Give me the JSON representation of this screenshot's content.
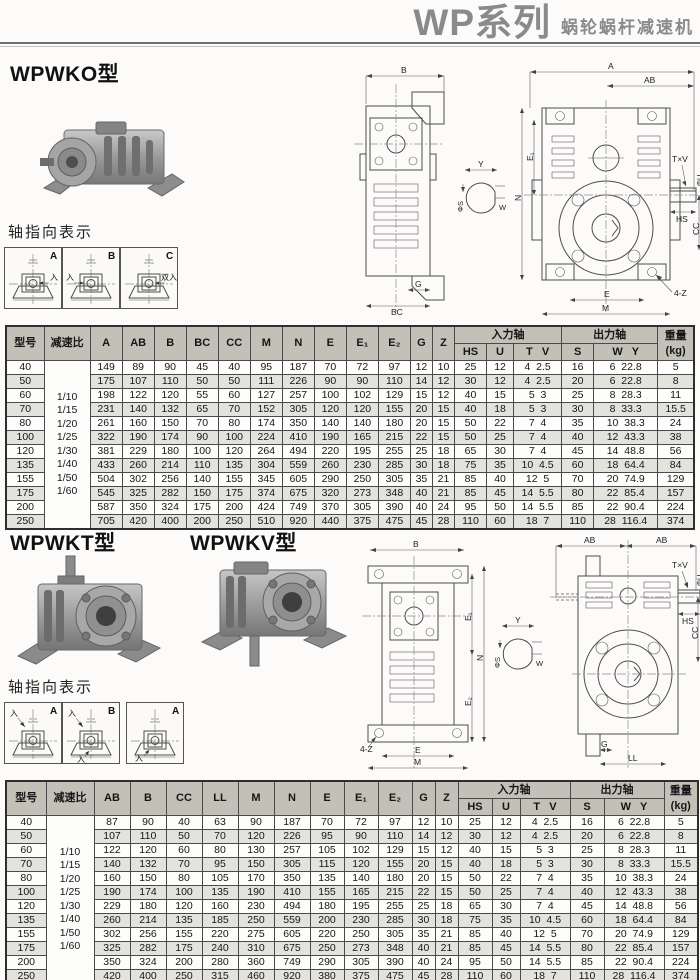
{
  "header": {
    "series": "WP系列",
    "subtitle": "蜗轮蜗杆减速机"
  },
  "sections": {
    "wpwko": {
      "title": "WPWKO型"
    },
    "wpwkt": {
      "title": "WPWKT型"
    },
    "wpwkv": {
      "title": "WPWKV型"
    }
  },
  "axis_sets": {
    "set1": {
      "label": "轴指向表示",
      "boxes": [
        {
          "letter": "A",
          "entry": "入"
        },
        {
          "letter": "B",
          "entry": "入"
        },
        {
          "letter": "C",
          "entry": "双入"
        }
      ]
    },
    "set2": {
      "label": "轴指向表示",
      "boxes": [
        {
          "letter": "A",
          "entry": "入"
        },
        {
          "letter": "B",
          "entry": "入",
          "entry2": "入"
        },
        {
          "letter": "A",
          "entry": "入"
        }
      ]
    }
  },
  "drawing_labels": {
    "a": "A",
    "ab": "AB",
    "b": "B",
    "bc": "BC",
    "cc": "CC",
    "g": "G",
    "m": "M",
    "n": "N",
    "e": "E",
    "e1": "E₁",
    "e2": "E₂",
    "z": "Z",
    "txv": "T×V",
    "u": "ΦU",
    "hs": "HS",
    "four_z": "4-Z",
    "y": "Y",
    "s": "ΦS",
    "w": "W",
    "ll": "LL"
  },
  "table1": {
    "headers": {
      "model": "型号",
      "ratio": "减速比",
      "dims": [
        "A",
        "AB",
        "B",
        "BC",
        "CC",
        "M",
        "N",
        "E",
        "E₁",
        "E₂",
        "G",
        "Z"
      ],
      "input": "入力轴",
      "input_cols": [
        "HS",
        "U",
        "T   V"
      ],
      "output": "出力轴",
      "output_cols": [
        "S",
        "W   Y"
      ],
      "weight": "重量\n(kg)"
    },
    "ratios": [
      "1/10",
      "1/15",
      "1/20",
      "1/25",
      "1/30",
      "1/40",
      "1/50",
      "1/60"
    ],
    "rows": [
      [
        "40",
        "149",
        "89",
        "90",
        "45",
        "40",
        "95",
        "187",
        "70",
        "72",
        "97",
        "12",
        "10",
        "25",
        "12",
        "4  2.5",
        "16",
        "6  22.8",
        "5"
      ],
      [
        "50",
        "175",
        "107",
        "110",
        "50",
        "50",
        "111",
        "226",
        "90",
        "90",
        "110",
        "14",
        "12",
        "30",
        "12",
        "4  2.5",
        "20",
        "6  22.8",
        "8"
      ],
      [
        "60",
        "198",
        "122",
        "120",
        "55",
        "60",
        "127",
        "257",
        "100",
        "102",
        "129",
        "15",
        "12",
        "40",
        "15",
        "5  3",
        "25",
        "8  28.3",
        "11"
      ],
      [
        "70",
        "231",
        "140",
        "132",
        "65",
        "70",
        "152",
        "305",
        "120",
        "120",
        "155",
        "20",
        "15",
        "40",
        "18",
        "5  3",
        "30",
        "8  33.3",
        "15.5"
      ],
      [
        "80",
        "261",
        "160",
        "150",
        "70",
        "80",
        "174",
        "350",
        "140",
        "140",
        "180",
        "20",
        "15",
        "50",
        "22",
        "7  4",
        "35",
        "10  38.3",
        "24"
      ],
      [
        "100",
        "322",
        "190",
        "174",
        "90",
        "100",
        "224",
        "410",
        "190",
        "165",
        "215",
        "22",
        "15",
        "50",
        "25",
        "7  4",
        "40",
        "12  43.3",
        "38"
      ],
      [
        "120",
        "381",
        "229",
        "180",
        "100",
        "120",
        "264",
        "494",
        "220",
        "195",
        "255",
        "25",
        "18",
        "65",
        "30",
        "7  4",
        "45",
        "14  48.8",
        "56"
      ],
      [
        "135",
        "433",
        "260",
        "214",
        "110",
        "135",
        "304",
        "559",
        "260",
        "230",
        "285",
        "30",
        "18",
        "75",
        "35",
        "10  4.5",
        "60",
        "18  64.4",
        "84"
      ],
      [
        "155",
        "504",
        "302",
        "256",
        "140",
        "155",
        "345",
        "605",
        "290",
        "250",
        "305",
        "35",
        "21",
        "85",
        "40",
        "12  5",
        "70",
        "20  74.9",
        "129"
      ],
      [
        "175",
        "545",
        "325",
        "282",
        "150",
        "175",
        "374",
        "675",
        "320",
        "273",
        "348",
        "40",
        "21",
        "85",
        "45",
        "14  5.5",
        "80",
        "22  85.4",
        "157"
      ],
      [
        "200",
        "587",
        "350",
        "324",
        "175",
        "200",
        "424",
        "749",
        "370",
        "305",
        "390",
        "40",
        "24",
        "95",
        "50",
        "14  5.5",
        "85",
        "22  90.4",
        "224"
      ],
      [
        "250",
        "705",
        "420",
        "400",
        "200",
        "250",
        "510",
        "920",
        "440",
        "375",
        "475",
        "45",
        "28",
        "110",
        "60",
        "18  7",
        "110",
        "28  116.4",
        "374"
      ]
    ]
  },
  "table2": {
    "headers": {
      "model": "型号",
      "ratio": "减速比",
      "dims": [
        "AB",
        "B",
        "CC",
        "LL",
        "M",
        "N",
        "E",
        "E₁",
        "E₂",
        "G",
        "Z"
      ],
      "input": "入力轴",
      "input_cols": [
        "HS",
        "U",
        "T   V"
      ],
      "output": "出力轴",
      "output_cols": [
        "S",
        "W   Y"
      ],
      "weight": "重量\n(kg)"
    },
    "ratios": [
      "1/10",
      "1/15",
      "1/20",
      "1/25",
      "1/30",
      "1/40",
      "1/50",
      "1/60"
    ],
    "rows": [
      [
        "40",
        "87",
        "90",
        "40",
        "63",
        "90",
        "187",
        "70",
        "72",
        "97",
        "12",
        "10",
        "25",
        "12",
        "4  2.5",
        "16",
        "6  22.8",
        "5"
      ],
      [
        "50",
        "107",
        "110",
        "50",
        "70",
        "120",
        "226",
        "95",
        "90",
        "110",
        "14",
        "12",
        "30",
        "12",
        "4  2.5",
        "20",
        "6  22.8",
        "8"
      ],
      [
        "60",
        "122",
        "120",
        "60",
        "80",
        "130",
        "257",
        "105",
        "102",
        "129",
        "15",
        "12",
        "40",
        "15",
        "5  3",
        "25",
        "8  28.3",
        "11"
      ],
      [
        "70",
        "140",
        "132",
        "70",
        "95",
        "150",
        "305",
        "115",
        "120",
        "155",
        "20",
        "15",
        "40",
        "18",
        "5  3",
        "30",
        "8  33.3",
        "15.5"
      ],
      [
        "80",
        "160",
        "150",
        "80",
        "105",
        "170",
        "350",
        "135",
        "140",
        "180",
        "20",
        "15",
        "50",
        "22",
        "7  4",
        "35",
        "10  38.3",
        "24"
      ],
      [
        "100",
        "190",
        "174",
        "100",
        "135",
        "190",
        "410",
        "155",
        "165",
        "215",
        "22",
        "15",
        "50",
        "25",
        "7  4",
        "40",
        "12  43.3",
        "38"
      ],
      [
        "120",
        "229",
        "180",
        "120",
        "160",
        "230",
        "494",
        "180",
        "195",
        "255",
        "25",
        "18",
        "65",
        "30",
        "7  4",
        "45",
        "14  48.8",
        "56"
      ],
      [
        "135",
        "260",
        "214",
        "135",
        "185",
        "250",
        "559",
        "200",
        "230",
        "285",
        "30",
        "18",
        "75",
        "35",
        "10  4.5",
        "60",
        "18  64.4",
        "84"
      ],
      [
        "155",
        "302",
        "256",
        "155",
        "220",
        "275",
        "605",
        "220",
        "250",
        "305",
        "35",
        "21",
        "85",
        "40",
        "12  5",
        "70",
        "20  74.9",
        "129"
      ],
      [
        "175",
        "325",
        "282",
        "175",
        "240",
        "310",
        "675",
        "250",
        "273",
        "348",
        "40",
        "21",
        "85",
        "45",
        "14  5.5",
        "80",
        "22  85.4",
        "157"
      ],
      [
        "200",
        "350",
        "324",
        "200",
        "280",
        "360",
        "749",
        "290",
        "305",
        "390",
        "40",
        "24",
        "95",
        "50",
        "14  5.5",
        "85",
        "22  90.4",
        "224"
      ],
      [
        "250",
        "420",
        "400",
        "250",
        "315",
        "460",
        "920",
        "380",
        "375",
        "475",
        "45",
        "28",
        "110",
        "60",
        "18  7",
        "110",
        "28  116.4",
        "374"
      ]
    ]
  }
}
